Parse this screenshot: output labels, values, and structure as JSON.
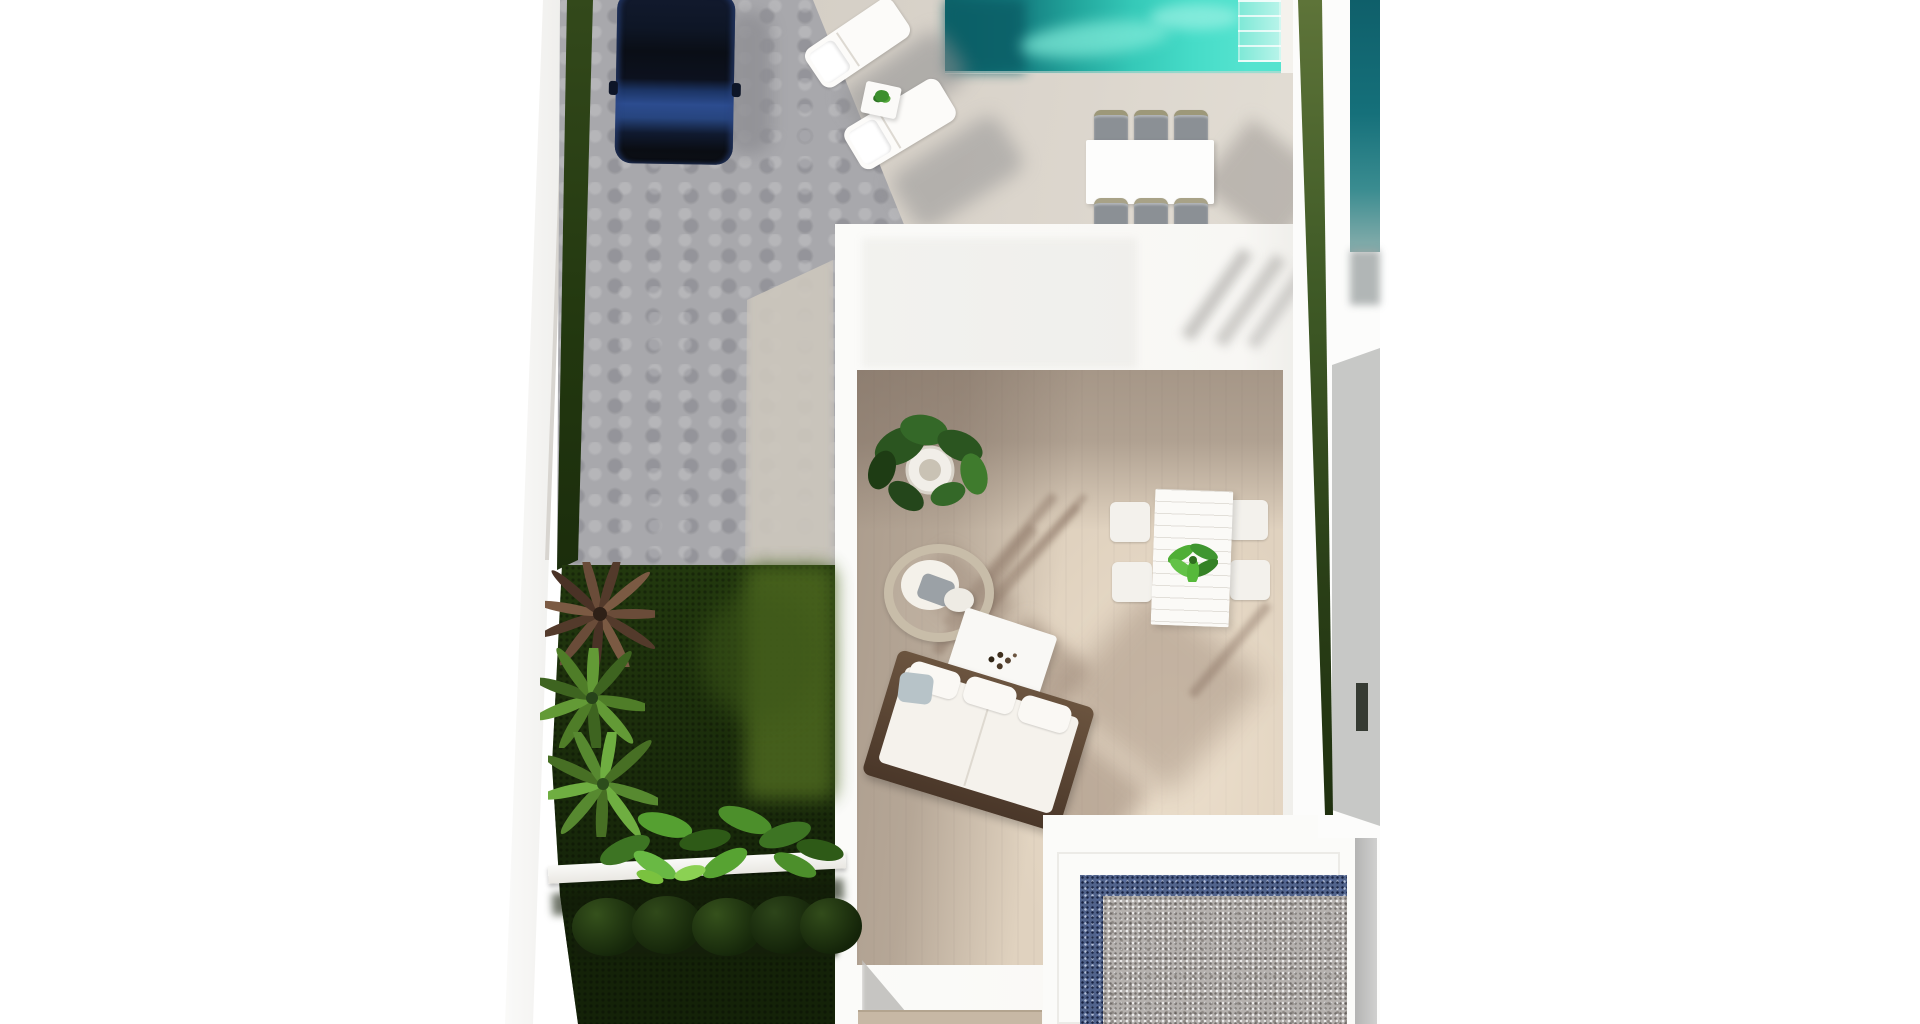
{
  "image": {
    "kind": "aerial-3d-architectural-render",
    "subject": "Top-down render of a modern villa plot: driveway with parked car, sun deck with loungers and pool, outdoor dining set, white flat-roofed house with open courtyard terrace (sofa, wicker chair, coffee table, dining table, potted plants), side garden with palms and hedges, and a gravel patio court",
    "visible_text": []
  },
  "palette": {
    "background": "#ffffff",
    "paving_gray": "#a8a8ac",
    "deck_beige": "#d8d2c9",
    "pool_teal_dark": "#0c6368",
    "pool_turquoise": "#40d5c0",
    "pool_steps_pale": "#9bf0e0",
    "lawn_dark": "#22380e",
    "lawn_light": "#4c671f",
    "hedge_green_dark": "#22370f",
    "hedge_green_light": "#5a7135",
    "roof_white": "#fbfbf9",
    "courtyard_floor_sun": "#e0d2bf",
    "courtyard_floor_shade": "#9e9186",
    "gravel_border_blue": "#51638b",
    "gravel_fill_gray": "#b4b0ad",
    "car_navy": "#16264d",
    "car_hood_blue": "#2c4c8f",
    "furniture_white": "#f7f5f0",
    "sofa_wood_brown": "#5c4836",
    "dining_chair_gray": "#8b9095",
    "wicker_rattan": "#c8bda9",
    "shadow_warm": "#7d6757"
  },
  "scene": {
    "parking": {
      "label": "paved driveway with dark navy SUV",
      "car_color": "#16264d"
    },
    "sun_deck": {
      "loungers": 2,
      "lounger_color": "#ffffff",
      "side_table_plant": true
    },
    "main_pool": {
      "position": "top-center",
      "colors": [
        "#0c6368",
        "#40d5c0"
      ],
      "steps": true
    },
    "outdoor_dining": {
      "table_color": "#fdfdfc",
      "chairs": 6,
      "chair_color": "#8b9095"
    },
    "house": {
      "roof_color": "#fbfbf9",
      "courtyard": {
        "floor_color": "#e0d2bf",
        "furniture": [
          "potted-fiddle-plant",
          "wicker-lounge-chair",
          "pouf",
          "coffee-table",
          "wood-frame-sofa",
          "dining-table-with-plant",
          "four-white-chairs"
        ]
      }
    },
    "garden": {
      "lawn_color": "#22380e",
      "plants": [
        "brown-palm",
        "green-palm",
        "green-palm",
        "banana-bushes",
        "trimmed-hedge-row"
      ],
      "planter_ledge_color": "#fafaf8"
    },
    "gravel_patio": {
      "border_color": "#51638b",
      "fill_color": "#b4b0ad",
      "frame_color": "#fbfbf9"
    },
    "neighbor_right": {
      "pool_color": "#11616c",
      "hedge_color": "#5a7135",
      "walkway_color": "#fcfcfb"
    }
  }
}
